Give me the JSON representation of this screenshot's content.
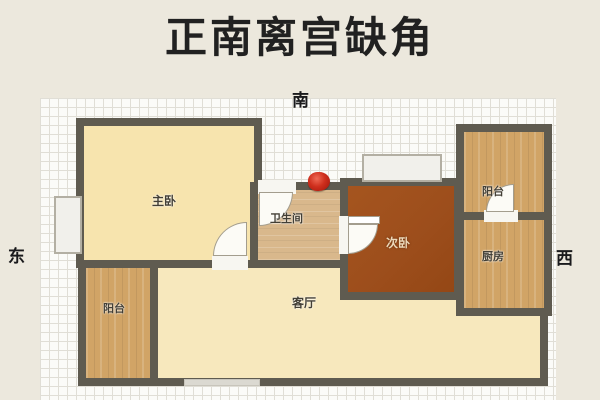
{
  "title": "正南离宫缺角",
  "compass": {
    "south": "南",
    "east": "东",
    "west": "西"
  },
  "rooms": {
    "master": {
      "label": "主卧"
    },
    "bathroom": {
      "label": "卫生间"
    },
    "second": {
      "label": "次卧"
    },
    "balcony_top": {
      "label": "阳台"
    },
    "kitchen": {
      "label": "厨房"
    },
    "balcony_bottom": {
      "label": "阳台"
    },
    "living": {
      "label": "客厅"
    }
  },
  "marker": {
    "color": "#c0271a"
  },
  "colors": {
    "page_bg": "#ece8dd",
    "wall": "#5f5b50",
    "floor_cream": "#f7e6b4",
    "floor_wood": "#d1a466",
    "floor_tan": "#d9b88c",
    "floor_dark_brown": "#9d4e1c",
    "grid_line": "#e0ded6"
  }
}
